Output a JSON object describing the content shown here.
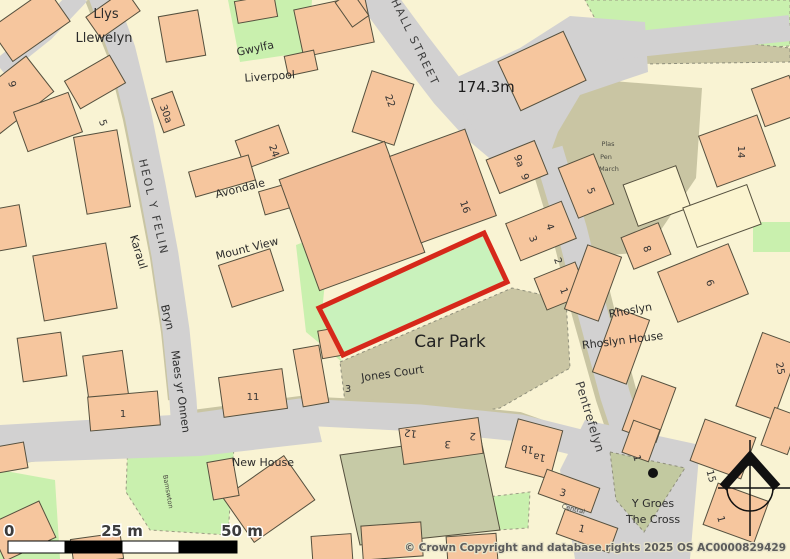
{
  "map": {
    "type": "ordnance-survey-style site plan",
    "highlight": "red site boundary around green plot beside Car Park",
    "colors": {
      "site_boundary_red": "#d6281a",
      "plot_green": "#c9f2bc",
      "road_gray": "#d2d1d1",
      "building_peach": "#f6c69e",
      "building_salmon": "#f2bd96",
      "green_space": "#c9f0ae",
      "hardstanding_tan": "#c9c5a3",
      "parcel_cream": "#f9f3d3"
    }
  },
  "labels": {
    "streets": [
      {
        "text": "HALL STREET"
      },
      {
        "text": "HEOL Y FELIN"
      },
      {
        "text": "Pentrefelyn"
      }
    ],
    "places": [
      {
        "text": "Llys"
      },
      {
        "text": "Llewelyn"
      },
      {
        "text": "Gwylfa"
      },
      {
        "text": "Liverpool"
      },
      {
        "text": "Avondale"
      },
      {
        "text": "Mount View"
      },
      {
        "text": "Karaul"
      },
      {
        "text": "Bryn"
      },
      {
        "text": "Maes yr Onnen"
      },
      {
        "text": "Jones Court"
      },
      {
        "text": "Car Park"
      },
      {
        "text": "Rhoslyn"
      },
      {
        "text": "Rhoslyn House"
      },
      {
        "text": "New House"
      },
      {
        "text": "Y Groes"
      },
      {
        "text": "The Cross"
      },
      {
        "text": "Plas"
      },
      {
        "text": "Pen"
      },
      {
        "text": "March"
      },
      {
        "text": "Central"
      },
      {
        "text": "Bamswton"
      },
      {
        "text": "174.3m"
      }
    ],
    "numbers": [
      {
        "text": "9"
      },
      {
        "text": "5"
      },
      {
        "text": "30a"
      },
      {
        "text": "24"
      },
      {
        "text": "22"
      },
      {
        "text": "16"
      },
      {
        "text": "9a"
      },
      {
        "text": "9"
      },
      {
        "text": "5"
      },
      {
        "text": "4"
      },
      {
        "text": "3"
      },
      {
        "text": "2"
      },
      {
        "text": "1"
      },
      {
        "text": "8"
      },
      {
        "text": "14"
      },
      {
        "text": "6"
      },
      {
        "text": "25"
      },
      {
        "text": "11"
      },
      {
        "text": "1"
      },
      {
        "text": "3"
      },
      {
        "text": "12"
      },
      {
        "text": "3"
      },
      {
        "text": "2"
      },
      {
        "text": "1b"
      },
      {
        "text": "1a"
      },
      {
        "text": "3"
      },
      {
        "text": "1"
      },
      {
        "text": "15"
      },
      {
        "text": "1"
      },
      {
        "text": "1"
      }
    ],
    "scalebar": {
      "start": "0",
      "mid": "25 m",
      "end": "50 m"
    },
    "copyright": "© Crown Copyright and database rights 2025 OS AC0000829429"
  }
}
